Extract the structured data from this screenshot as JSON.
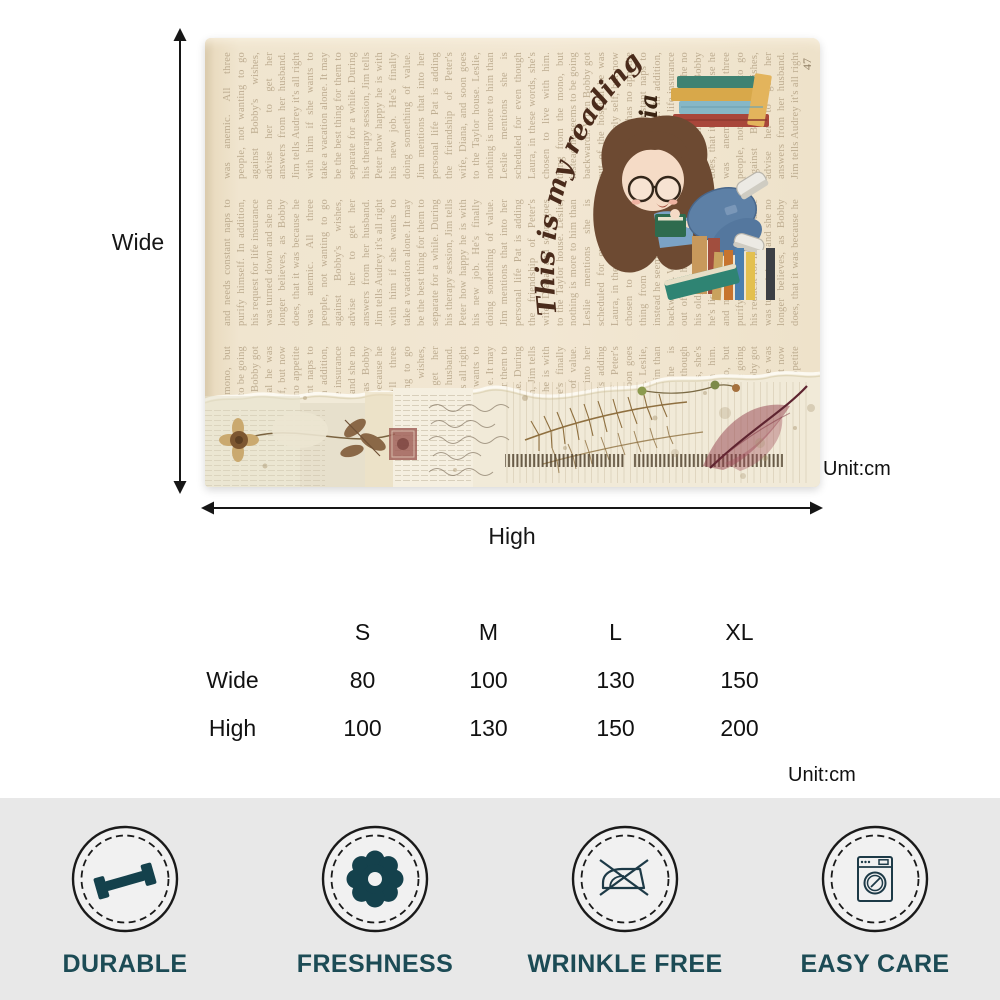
{
  "diagram": {
    "wide_label": "Wide",
    "high_label": "High",
    "unit_label": "Unit:cm"
  },
  "blanket": {
    "arc_text": "This is my reading blanket",
    "girl_name": "Sophia",
    "page_number": "47",
    "page_text": "thing from the mono, but instead he seems to be going backwards. When Bobby got out of the hospital he was his old, lively self, but now he's listless, has no appetite and needs constant naps to purify himself. In addition, his request for life insurance was turned down and she no longer believes, as Bobby does, that it was because he was anemic. All three people, not wanting to go against Bobby's wishes, advise her to get her answers from her husband. Jim tells Audrey it's all right with him if she wants to take a vacation alone. It may be the best thing for them to separate for a while. During his therapy session, Jim tells Peter how happy he is with his new job. He's finally doing something of value. Jim mentions that into her personal life Pat is adding the friendship of Peter's wife, Diana, and soon goes to the Taylor house. Leslie, nothing is more to him than Leslie mentions she is scheduled for even though Laura, in these words, she's chosen to live with him.",
    "colors": {
      "base": "#efe3cc",
      "script_text": "#4a2b1b",
      "faded_text": "#b5a386"
    }
  },
  "size_table": {
    "columns": [
      "S",
      "M",
      "L",
      "XL"
    ],
    "rows": [
      {
        "label": "Wide",
        "values": [
          "80",
          "100",
          "130",
          "150"
        ]
      },
      {
        "label": "High",
        "values": [
          "100",
          "130",
          "150",
          "200"
        ]
      }
    ],
    "unit_label": "Unit:cm"
  },
  "features": {
    "band_color": "#e8e8e8",
    "icon_color": "#14414c",
    "label_color": "#1c4b55",
    "items": [
      {
        "label": "DURABLE",
        "icon": "dumbbell-icon"
      },
      {
        "label": "FRESHNESS",
        "icon": "flower-icon"
      },
      {
        "label": "WRINKLE FREE",
        "icon": "no-iron-icon"
      },
      {
        "label": "EASY CARE",
        "icon": "washing-machine-icon"
      }
    ]
  }
}
